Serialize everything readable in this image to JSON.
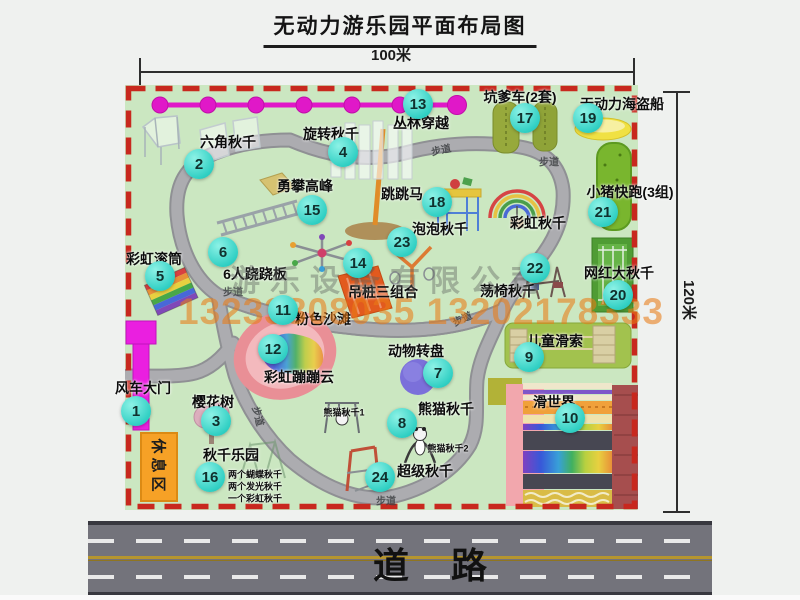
{
  "title": "无动力游乐园平面布局图",
  "dimensions": {
    "width": "100米",
    "height": "120米"
  },
  "road": {
    "label": "道路"
  },
  "watermark": {
    "company": "游乐设备有限公司",
    "phone": "13233808035 13202178333"
  },
  "rest_area": {
    "label": "休息区"
  },
  "walkway": {
    "label": "步道"
  },
  "colors": {
    "map_green": "#cbe7c1",
    "border_red": "#c8281e",
    "badge_teal": "#2fcfc3",
    "gate_magenta": "#ea1fe0",
    "zipline_magenta": "#e018c8",
    "watermark_orange": "#e97c16",
    "road_gray": "#73737b"
  },
  "attractions": [
    {
      "num": "1",
      "label": "风车大门"
    },
    {
      "num": "2",
      "label": "六角秋千"
    },
    {
      "num": "3",
      "label": "樱花树"
    },
    {
      "num": "4",
      "label": "旋转秋千"
    },
    {
      "num": "5",
      "label": "彩虹滚筒"
    },
    {
      "num": "6",
      "label": "6人跷跷板"
    },
    {
      "num": "7",
      "label": "动物转盘"
    },
    {
      "num": "8",
      "label": "熊猫秋千"
    },
    {
      "num": "9",
      "label": "儿童滑索"
    },
    {
      "num": "10",
      "label": "滑世界"
    },
    {
      "num": "11",
      "label": "粉色沙滩"
    },
    {
      "num": "12",
      "label": "彩虹蹦蹦云"
    },
    {
      "num": "13",
      "label": "丛林穿越"
    },
    {
      "num": "14",
      "label": "吊桩三组合"
    },
    {
      "num": "15",
      "label": "勇攀高峰"
    },
    {
      "num": "16",
      "label": "秋千乐园"
    },
    {
      "num": "17",
      "label": "坑爹车(2套)"
    },
    {
      "num": "18",
      "label": "跳跳马"
    },
    {
      "num": "19",
      "label": "无动力海盗船"
    },
    {
      "num": "20",
      "label": "网红大秋千"
    },
    {
      "num": "21",
      "label": "小猪快跑(3组)"
    },
    {
      "num": "22",
      "label": "荡椅秋千"
    },
    {
      "num": "23",
      "label": "泡泡秋千"
    },
    {
      "num": "24",
      "label": "超级秋千"
    }
  ],
  "extra": {
    "rainbow_swing": "彩虹秋千",
    "panda_swing_1": "熊猫秋千1",
    "panda_swing_2": "熊猫秋千2",
    "swing_notes": [
      "两个蝴蝶秋千",
      "两个发光秋千",
      "一个彩虹秋千"
    ]
  }
}
